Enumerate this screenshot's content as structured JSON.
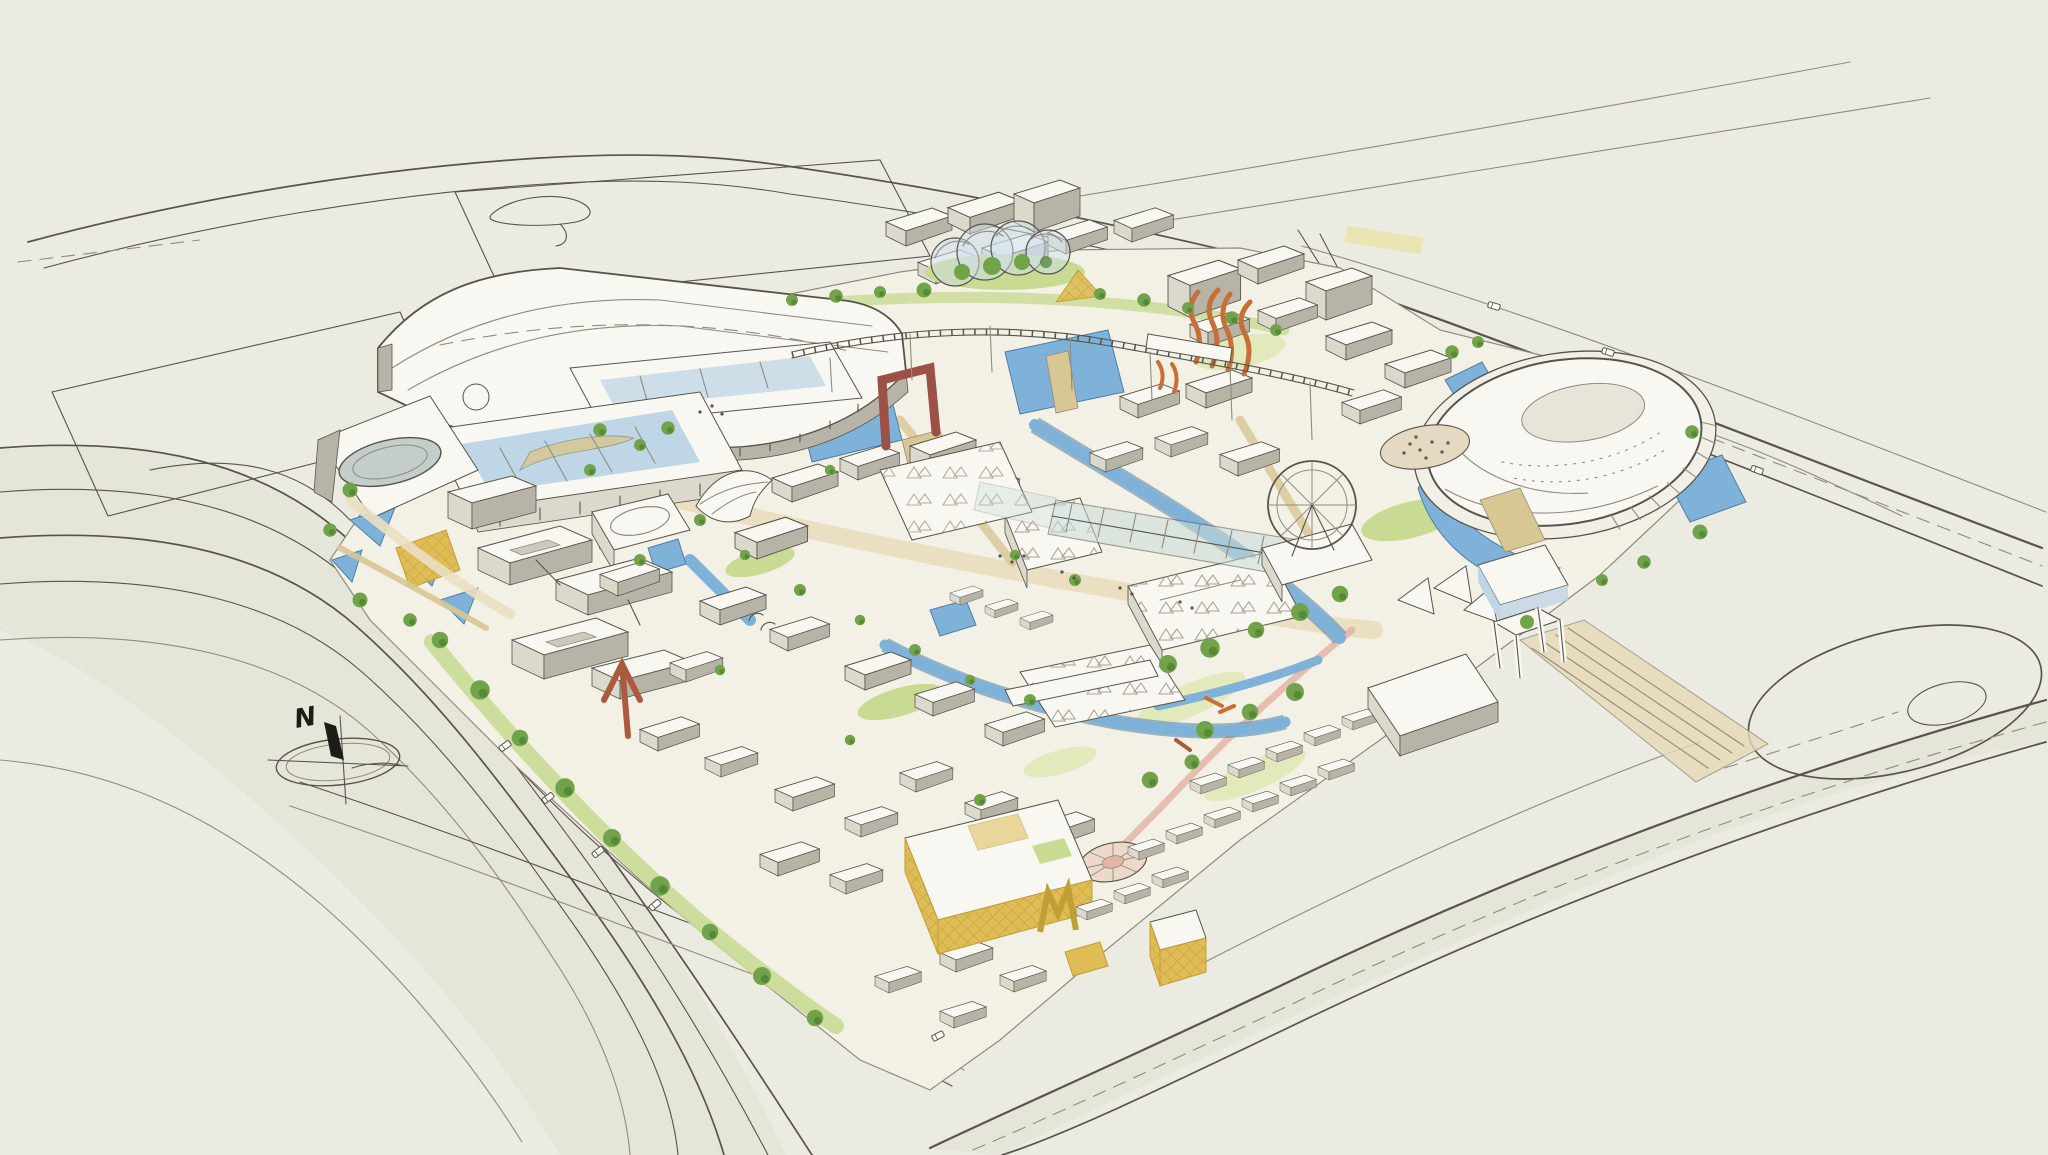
{
  "scene": {
    "kind": "hand-drawn aerial perspective master plan sketch",
    "compass": {
      "north_label": "N"
    },
    "features": [
      "perimeter-roads",
      "parking-lots",
      "transit-hall",
      "retail-mall-glass-atrium",
      "oval-skylight-pavilion",
      "event-plaza-water-gardens",
      "campus-office-blocks",
      "canal-network",
      "central-glass-canopy",
      "biodome-greenhouses",
      "gold-lattice-pavilion",
      "orange-sculpture-towers",
      "maroon-gate",
      "monorail-line",
      "ferris-wheel",
      "arena-dome",
      "white-gateway-frame",
      "pedestrian-overpass",
      "gold-market-hall",
      "m-arch-sculpture",
      "amphitheater-circle",
      "rowhouse-quarter",
      "tent-sails",
      "jogging-path",
      "roundabout",
      "compass-rose"
    ]
  },
  "palette": {
    "paper": "#ECEBE2",
    "plate": "#F3F1E6",
    "shadow": "#E2E0D3",
    "ink": "#56544C",
    "inkSoft": "#8E8C81",
    "bldgTop": "#F8F7F1",
    "bldgFace": "#DBD8CC",
    "bldgShade": "#B7B4A7",
    "glassRoof": "#C8DCD6",
    "glassBlue": "#BFD6E6",
    "water": "#7FB2D9",
    "waterEdge": "#4F7FA6",
    "treeGreen": "#71A44A",
    "treeDark": "#4C7D30",
    "lawn": "#C9DB93",
    "lawnPale": "#E2EABC",
    "plaza": "#EADFC1",
    "sand": "#D8C693",
    "tanStrip": "#E7E3A0",
    "gold": "#DFBC55",
    "goldDeep": "#C19F35",
    "orange": "#C86F38",
    "rust": "#AC5A3E",
    "maroon": "#9C5046",
    "pink": "#E3B5A5",
    "overpass": "#E6D9B4"
  }
}
